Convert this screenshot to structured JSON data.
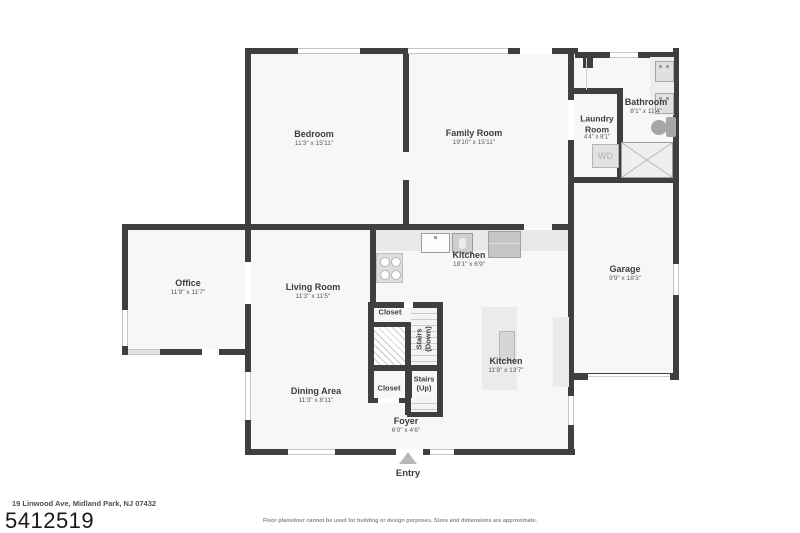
{
  "colors": {
    "wall": "#3f3f3f",
    "floor": "#f7f7f8",
    "fixture": "#e9e9e9",
    "label_text": "#3d3d3d"
  },
  "plan": {
    "rooms": [
      {
        "id": "bedroom",
        "name": "Bedroom",
        "dims": "11'3\" x 15'11\""
      },
      {
        "id": "family-room",
        "name": "Family Room",
        "dims": "19'10\" x 15'11\""
      },
      {
        "id": "laundry-room",
        "name": "Laundry Room",
        "dims": "4'4\" x 8'1\""
      },
      {
        "id": "bathroom",
        "name": "Bathroom",
        "dims": "8'1\" x 11'4\""
      },
      {
        "id": "office",
        "name": "Office",
        "dims": "11'9\" x 11'7\""
      },
      {
        "id": "living-room",
        "name": "Living Room",
        "dims": "11'3\" x 11'5\""
      },
      {
        "id": "kitchen",
        "name": "Kitchen",
        "dims": "18'1\" x 6'9\""
      },
      {
        "id": "garage",
        "name": "Garage",
        "dims": "9'9\" x 18'3\""
      },
      {
        "id": "kitchen-2",
        "name": "Kitchen",
        "dims": "11'8\" x 13'7\""
      },
      {
        "id": "dining-area",
        "name": "Dining Area",
        "dims": "11'3\" x 8'11\""
      },
      {
        "id": "foyer",
        "name": "Foyer",
        "dims": "6'0\" x 4'6\""
      }
    ],
    "features": {
      "closet_top": "Closet",
      "closet_bottom": "Closet",
      "stairs_down_line1": "Stairs",
      "stairs_down_line2": "(Down)",
      "stairs_up_line1": "Stairs",
      "stairs_up_line2": "(Up)",
      "washer_dryer": "WD",
      "entry": "Entry"
    }
  },
  "footer": {
    "address": "19 Linwood Ave, Midland Park, NJ 07432",
    "plan_number": "5412519",
    "disclaimer": "Floor plans/tour cannot be used for building or design purposes. Sizes and dimensions are approximate."
  }
}
